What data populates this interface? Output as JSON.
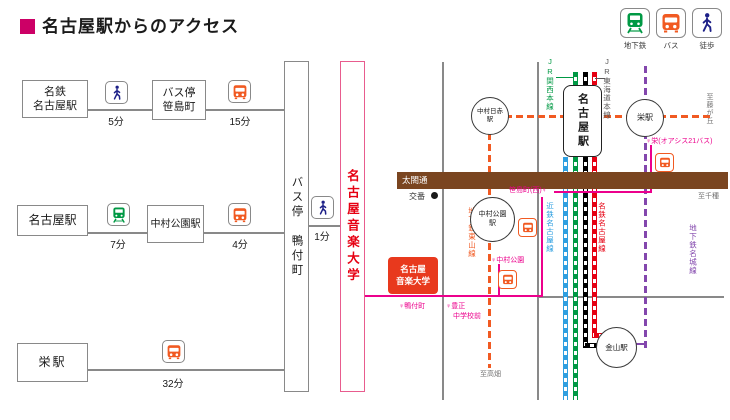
{
  "title": "名古屋駅からのアクセス",
  "legend": {
    "subway": "地下鉄",
    "bus": "バス",
    "walk": "徒歩"
  },
  "flowchart": {
    "row1": {
      "origin1": "名鉄",
      "origin2": "名古屋駅",
      "time1": "5分",
      "mid1": "バス停",
      "mid2": "笹島町",
      "time2": "15分"
    },
    "row2": {
      "origin": "名古屋駅",
      "time1": "7分",
      "mid": "中村公園駅",
      "time2": "4分"
    },
    "row3": {
      "origin": "栄駅",
      "time1": "32分"
    },
    "busstop_box": "バス停 鴨付町",
    "walk_time": "1分",
    "college_box": "名古屋音楽大学"
  },
  "map": {
    "road_name": "太閤通",
    "koban": "交番",
    "stations": {
      "nagoya": "名古屋駅",
      "nakamura_nisseki1": "中村日赤",
      "nakamura_nisseki2": "駅",
      "nakamura_koen1": "中村公園",
      "nakamura_koen2": "駅",
      "sakae": "栄駅",
      "kanayama": "金山駅"
    },
    "college1": "名古屋",
    "college2": "音楽大学",
    "lines": {
      "jr_kansai": "JR関西本線",
      "jr_tokaido": "JR東海道本線",
      "kintetsu": "近鉄名古屋線",
      "meitetsu": "名鉄名古屋線",
      "higashiyama": "地下鉄東山線",
      "meijo": "地下鉄名城線"
    },
    "bus_stops": {
      "sakae": "♀栄(オアシス21バス)",
      "sasashima": "笹島町(西)♀",
      "nakamura_koen": "♀中村公園",
      "kamotsuke": "♀鴨付町",
      "toyosho1": "♀豊正",
      "toyosho2": "中学校前"
    },
    "directions": {
      "fujigaoka": "至藤が丘",
      "chikusa": "至千種",
      "takabata": "至高畑"
    }
  },
  "colors": {
    "accent": "#cc0066",
    "bus_route": "#ec008c",
    "subway_higashiyama": "#f15a22",
    "subway_meijo": "#8347ad",
    "rail_kintetsu_blue": "#2e9fe0",
    "rail_jr_kansai_green": "#009944",
    "rail_jr_tokaido_black": "#000000",
    "rail_meitetsu_red": "#e60012",
    "road_brown": "#7a4520",
    "road_gray": "#898989",
    "college_red": "#e8391d"
  }
}
